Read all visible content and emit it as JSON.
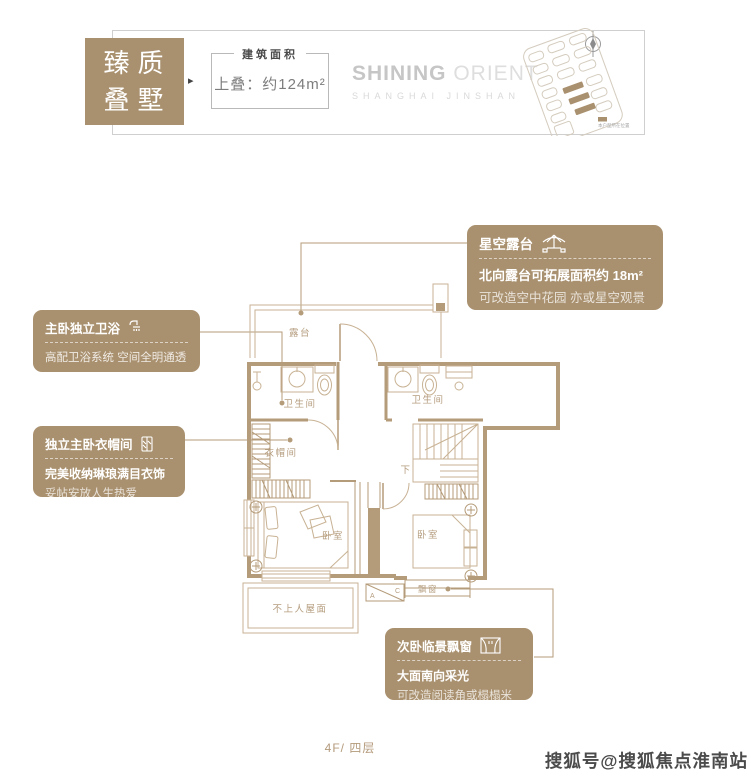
{
  "colors": {
    "accent": "#a9906e",
    "wall": "#b49b79",
    "thin_line": "#c8b294",
    "label": "#b59d7f"
  },
  "header": {
    "title_line1": "臻质",
    "title_line2": "叠墅",
    "arrow": "▸",
    "area_label": "建筑面积",
    "area_value": "上叠：约124m²",
    "brand_strong": "SHINING",
    "brand_light": " ORIENT",
    "brand_sub": "SHANGHAI JINSHAN",
    "siteplan_legend": "本户型所在位置"
  },
  "callouts": {
    "terrace": {
      "title": "星空露台",
      "line1": "北向露台可拓展面积约 18m²",
      "line2": "可改造空中花园 亦或星空观景台"
    },
    "bath": {
      "title": "主卧独立卫浴",
      "line1": "高配卫浴系统 空间全明通透"
    },
    "cloak": {
      "title": "独立主卧衣帽间",
      "line1": "完美收纳琳琅满目衣饰",
      "line2": "妥帖安放人生热爱"
    },
    "bay": {
      "title": "次卧临景飘窗",
      "line1": "大面南向采光",
      "line2": "可改造阅读角或榻榻米"
    }
  },
  "plan": {
    "labels": {
      "terrace": "露台",
      "bath_left": "卫生间",
      "bath_right": "卫生间",
      "cloak": "衣帽间",
      "down": "下",
      "bed_left": "卧室",
      "bed_right": "卧室",
      "bay": "飘窗",
      "roof": "不上人屋面",
      "ac_a": "A",
      "ac_c": "C"
    }
  },
  "footer": {
    "floor": "4F/ 四层",
    "watermark": "搜狐号@搜狐焦点淮南站"
  }
}
